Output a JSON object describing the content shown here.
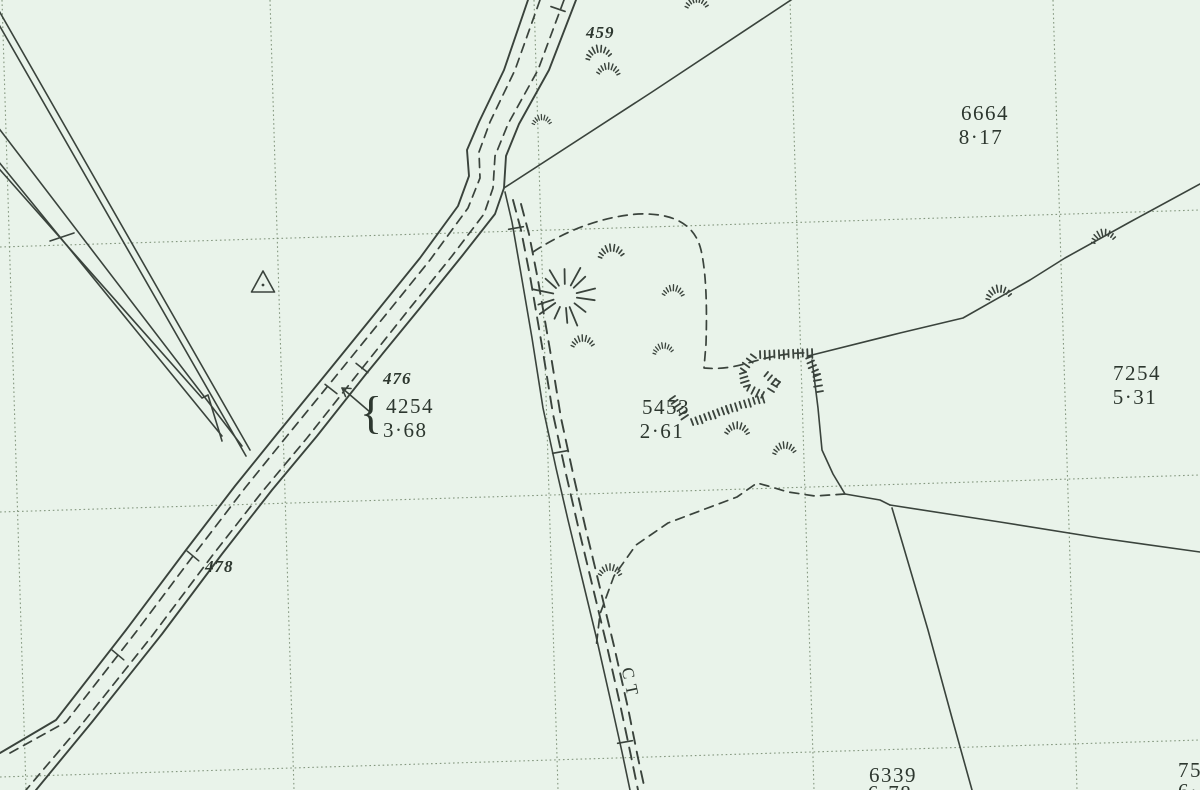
{
  "document": {
    "kind": "scanned large-scale field survey map extract"
  },
  "colors": {
    "paper": "#e9f3ea",
    "ink": "#3a433c",
    "grid_dots": "#84977f",
    "text": "#2d372f"
  },
  "labels": {
    "boundary_mereing": "CT",
    "brace": "{"
  },
  "parcels": [
    {
      "number": "6664",
      "area": "8·17"
    },
    {
      "number": "7254",
      "area": "5·31"
    },
    {
      "number": "5453",
      "area": "2·61"
    },
    {
      "number": "4254",
      "area": "3·68"
    },
    {
      "number": "6339",
      "area": "6·78"
    },
    {
      "number": "75",
      "area": "6·"
    }
  ],
  "road_numbers": [
    {
      "text": "459"
    },
    {
      "text": "476"
    },
    {
      "text": "478"
    }
  ],
  "symbols": {
    "triangle_station": "small triangle with centre dot",
    "sunburst": "radiating strokes mark",
    "rough_grass": "arc tuft marks",
    "slope": "hatched slope strokes",
    "gate_ticks": "cross ticks on road and track casing"
  }
}
